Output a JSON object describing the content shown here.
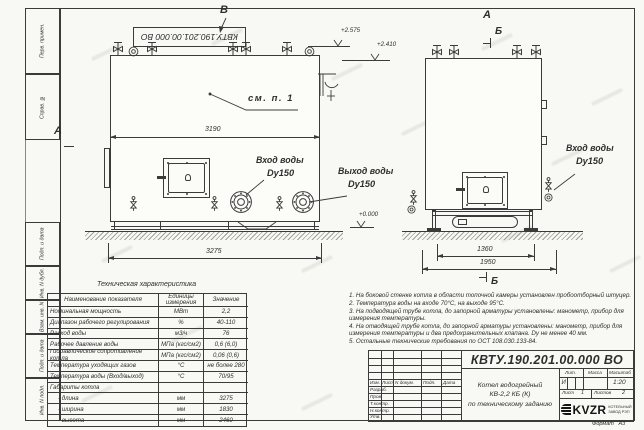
{
  "frame": {
    "stamp": "КВТУ.190.201.00.000 ВО",
    "col_top": [
      "Перв. примен.",
      "Справ. №"
    ],
    "col_bottom": [
      "Подп. и дата",
      "Инв. N дубл.",
      "Взам. инв. N",
      "Подп. и дата",
      "Инв. N подл."
    ],
    "format_label": "Формат",
    "format_value": "А3"
  },
  "drawing": {
    "view_v": "В",
    "section_a_left": "А",
    "section_a_right": "А",
    "section_b_top": "Б",
    "section_b_bottom": "Б",
    "callout": "см. п. 1",
    "dims": {
      "left_inner": "3190",
      "left_overall": "3275",
      "right_inner": "1360",
      "right_overall": "1950"
    },
    "levels": {
      "l1": "+2.575",
      "l2": "+2.410",
      "zero": "+0.000"
    },
    "labels": {
      "inlet1": "Вход воды",
      "inlet1_dn": "Dy150",
      "outlet": "Выход воды",
      "outlet_dn": "Dy150",
      "inlet2": "Вход воды",
      "inlet2_dn": "Dy150"
    }
  },
  "table": {
    "title": "Техническая характеристика",
    "headers": [
      "Наименование показателя",
      "Единицы измерения",
      "Значение"
    ],
    "rows": [
      {
        "name": "Номинальная мощность",
        "unit": "МВт",
        "value": "2,2"
      },
      {
        "name": "Диапазон рабочего регулирования",
        "unit": "%",
        "value": "40-110"
      },
      {
        "name": "Расход воды",
        "unit": "м3/ч",
        "value": "76"
      },
      {
        "name": "Рабочее давление воды",
        "unit": "МПа (кгс/см2)",
        "value": "0,6 (6,0)"
      },
      {
        "name": "Гидравлическое сопротивление котла",
        "unit": "МПа (кгс/см2)",
        "value": "0,06 (0,6)"
      },
      {
        "name": "Температура уходящих газов",
        "unit": "°С",
        "value": "не более 280"
      },
      {
        "name": "Температура воды (Вход/выход)",
        "unit": "°С",
        "value": "70/95"
      },
      {
        "name": "Габариты котла",
        "unit": "",
        "value": ""
      },
      {
        "name": "- длина",
        "unit": "мм",
        "value": "3275"
      },
      {
        "name": "- ширина",
        "unit": "мм",
        "value": "1830"
      },
      {
        "name": "- высота",
        "unit": "мм",
        "value": "2460"
      }
    ]
  },
  "notes": [
    "1. На боковой стенке котла в области топочной камеры установлен пробоотборный штуцер.",
    "2. Температура воды на входе 70°С, на выходе 95°С.",
    "3. На подводящей трубе котла, до запорной арматуры установлены: манометр, прибор для измерения температуры.",
    "4. На отводящей трубе котла, до запорной арматуры установлены: манометр, прибор для измерения температуры и два предохранительных клапана. Dу не менее 40 мм.",
    "5. Остальные технические требования по ОСТ 108.030.133-84."
  ],
  "title_block": {
    "doc_number": "КВТУ.190.201.00.000  ВО",
    "title_line1": "Котел водогрейный",
    "title_line2": "КВ-2,2 КБ (К)",
    "title_line3": "по техническому заданию",
    "header_cols": [
      "Изм.",
      "Лист",
      "N докум.",
      "Подп.",
      "Дата"
    ],
    "row_labels": [
      "Разраб.",
      "Пров.",
      "Т.контр.",
      "Н.контр.",
      "Утв."
    ],
    "lit_label": "Лит.",
    "mass_label": "Масса",
    "scale_label": "Масштаб",
    "lit_value": "И",
    "scale_value": "1:20",
    "sheet_label": "Лист",
    "sheet_value": "1",
    "sheets_label": "Листов",
    "sheets_value": "2",
    "logo_text": "KVZR",
    "logo_sub1": "КОТЕЛЬНЫЙ",
    "logo_sub2": "ЗАВОД РЭП"
  }
}
